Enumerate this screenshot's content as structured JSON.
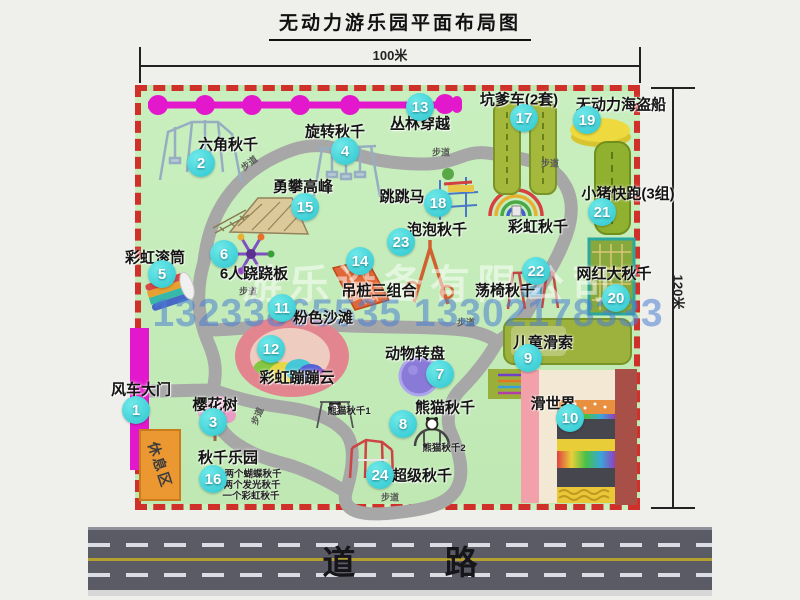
{
  "title": "无动力游乐园平面布局图",
  "dimensions": {
    "top": "100米",
    "right": "120米"
  },
  "road": {
    "label": "道  路"
  },
  "watermark": {
    "company": "游乐设备有限公司",
    "phone": "13233865535 13302178333"
  },
  "rest_area": {
    "label": "休息区"
  },
  "colors": {
    "park_green": "#c5ecbb",
    "border_red": "#d0302a",
    "path_gray": "#a7a7a7",
    "badge_cyan": "#2cc6cf",
    "chain_magenta": "#e318cc",
    "gate_magenta": "#e318cc",
    "road_gray": "#5b5b65",
    "rest_orange": "#eb9832",
    "watermark_blue": "#4a7ed2"
  },
  "attractions": [
    {
      "num": "1",
      "name": "风车大门",
      "badge": {
        "x": 136,
        "y": 410
      },
      "label": {
        "x": 141,
        "y": 389
      }
    },
    {
      "num": "2",
      "name": "六角秋千",
      "badge": {
        "x": 201,
        "y": 163
      },
      "label": {
        "x": 228,
        "y": 144
      }
    },
    {
      "num": "3",
      "name": "樱花树",
      "badge": {
        "x": 213,
        "y": 422
      },
      "label": {
        "x": 215,
        "y": 404
      }
    },
    {
      "num": "4",
      "name": "旋转秋千",
      "badge": {
        "x": 345,
        "y": 151
      },
      "label": {
        "x": 335,
        "y": 131
      }
    },
    {
      "num": "5",
      "name": "彩虹滚筒",
      "badge": {
        "x": 162,
        "y": 274
      },
      "label": {
        "x": 155,
        "y": 257
      }
    },
    {
      "num": "6",
      "name": "6人跷跷板",
      "badge": {
        "x": 224,
        "y": 254
      },
      "label": {
        "x": 254,
        "y": 273
      }
    },
    {
      "num": "7",
      "name": "动物转盘",
      "badge": {
        "x": 440,
        "y": 374
      },
      "label": {
        "x": 415,
        "y": 353
      }
    },
    {
      "num": "8",
      "name": "熊猫秋千",
      "badge": {
        "x": 403,
        "y": 424
      },
      "label": {
        "x": 445,
        "y": 407
      }
    },
    {
      "num": "9",
      "name": "儿童滑索",
      "badge": {
        "x": 528,
        "y": 358
      },
      "label": {
        "x": 543,
        "y": 342
      }
    },
    {
      "num": "10",
      "name": "滑世界",
      "badge": {
        "x": 570,
        "y": 418
      },
      "label": {
        "x": 553,
        "y": 403
      }
    },
    {
      "num": "11",
      "name": "粉色沙滩",
      "badge": {
        "x": 282,
        "y": 308
      },
      "label": {
        "x": 323,
        "y": 317
      }
    },
    {
      "num": "12",
      "name": "彩虹蹦蹦云",
      "badge": {
        "x": 271,
        "y": 349
      },
      "label": {
        "x": 297,
        "y": 377
      }
    },
    {
      "num": "13",
      "name": "丛林穿越",
      "badge": {
        "x": 420,
        "y": 107
      },
      "label": {
        "x": 420,
        "y": 123
      }
    },
    {
      "num": "14",
      "name": "吊桩三组合",
      "badge": {
        "x": 360,
        "y": 261
      },
      "label": {
        "x": 379,
        "y": 290
      }
    },
    {
      "num": "15",
      "name": "勇攀高峰",
      "badge": {
        "x": 305,
        "y": 207
      },
      "label": {
        "x": 303,
        "y": 186
      }
    },
    {
      "num": "16",
      "name": "秋千乐园",
      "badge": {
        "x": 213,
        "y": 479
      },
      "label": {
        "x": 228,
        "y": 457
      }
    },
    {
      "num": "17",
      "name": "坑爹车(2套)",
      "badge": {
        "x": 524,
        "y": 118
      },
      "label": {
        "x": 519,
        "y": 99
      }
    },
    {
      "num": "18",
      "name": "跳跳马",
      "badge": {
        "x": 438,
        "y": 203
      },
      "label": {
        "x": 402,
        "y": 196
      }
    },
    {
      "num": "19",
      "name": "无动力海盗船",
      "badge": {
        "x": 587,
        "y": 120
      },
      "label": {
        "x": 621,
        "y": 104
      }
    },
    {
      "num": "20",
      "name": "网红大秋千",
      "badge": {
        "x": 616,
        "y": 298
      },
      "label": {
        "x": 614,
        "y": 273
      }
    },
    {
      "num": "21",
      "name": "小猪快跑(3组)",
      "badge": {
        "x": 602,
        "y": 212
      },
      "label": {
        "x": 628,
        "y": 193
      }
    },
    {
      "num": "22",
      "name": "荡椅秋千",
      "badge": {
        "x": 536,
        "y": 271
      },
      "label": {
        "x": 505,
        "y": 290
      }
    },
    {
      "num": "23",
      "name": "泡泡秋千",
      "badge": {
        "x": 401,
        "y": 242
      },
      "label": {
        "x": 437,
        "y": 229
      }
    },
    {
      "num": "24",
      "name": "超级秋千",
      "badge": {
        "x": 380,
        "y": 475
      },
      "label": {
        "x": 422,
        "y": 475
      }
    },
    {
      "num": null,
      "name": "彩虹秋千",
      "badge": null,
      "label": {
        "x": 538,
        "y": 226
      }
    }
  ],
  "sub_labels": [
    {
      "text": "熊猫秋千1",
      "x": 349,
      "y": 410
    },
    {
      "text": "熊猫秋千2",
      "x": 444,
      "y": 447
    },
    {
      "text": "两个蝴蝶秋千",
      "x": 253,
      "y": 473
    },
    {
      "text": "两个发光秋千",
      "x": 252,
      "y": 484
    },
    {
      "text": "一个彩虹秋千",
      "x": 251,
      "y": 495
    }
  ],
  "trail_label": "步道",
  "trail_positions": [
    {
      "x": 249,
      "y": 163,
      "rot": -38
    },
    {
      "x": 441,
      "y": 152,
      "rot": 0
    },
    {
      "x": 550,
      "y": 163,
      "rot": 0
    },
    {
      "x": 248,
      "y": 291,
      "rot": 0
    },
    {
      "x": 257,
      "y": 416,
      "rot": -68
    },
    {
      "x": 466,
      "y": 322,
      "rot": 0
    },
    {
      "x": 390,
      "y": 497,
      "rot": 0
    }
  ]
}
